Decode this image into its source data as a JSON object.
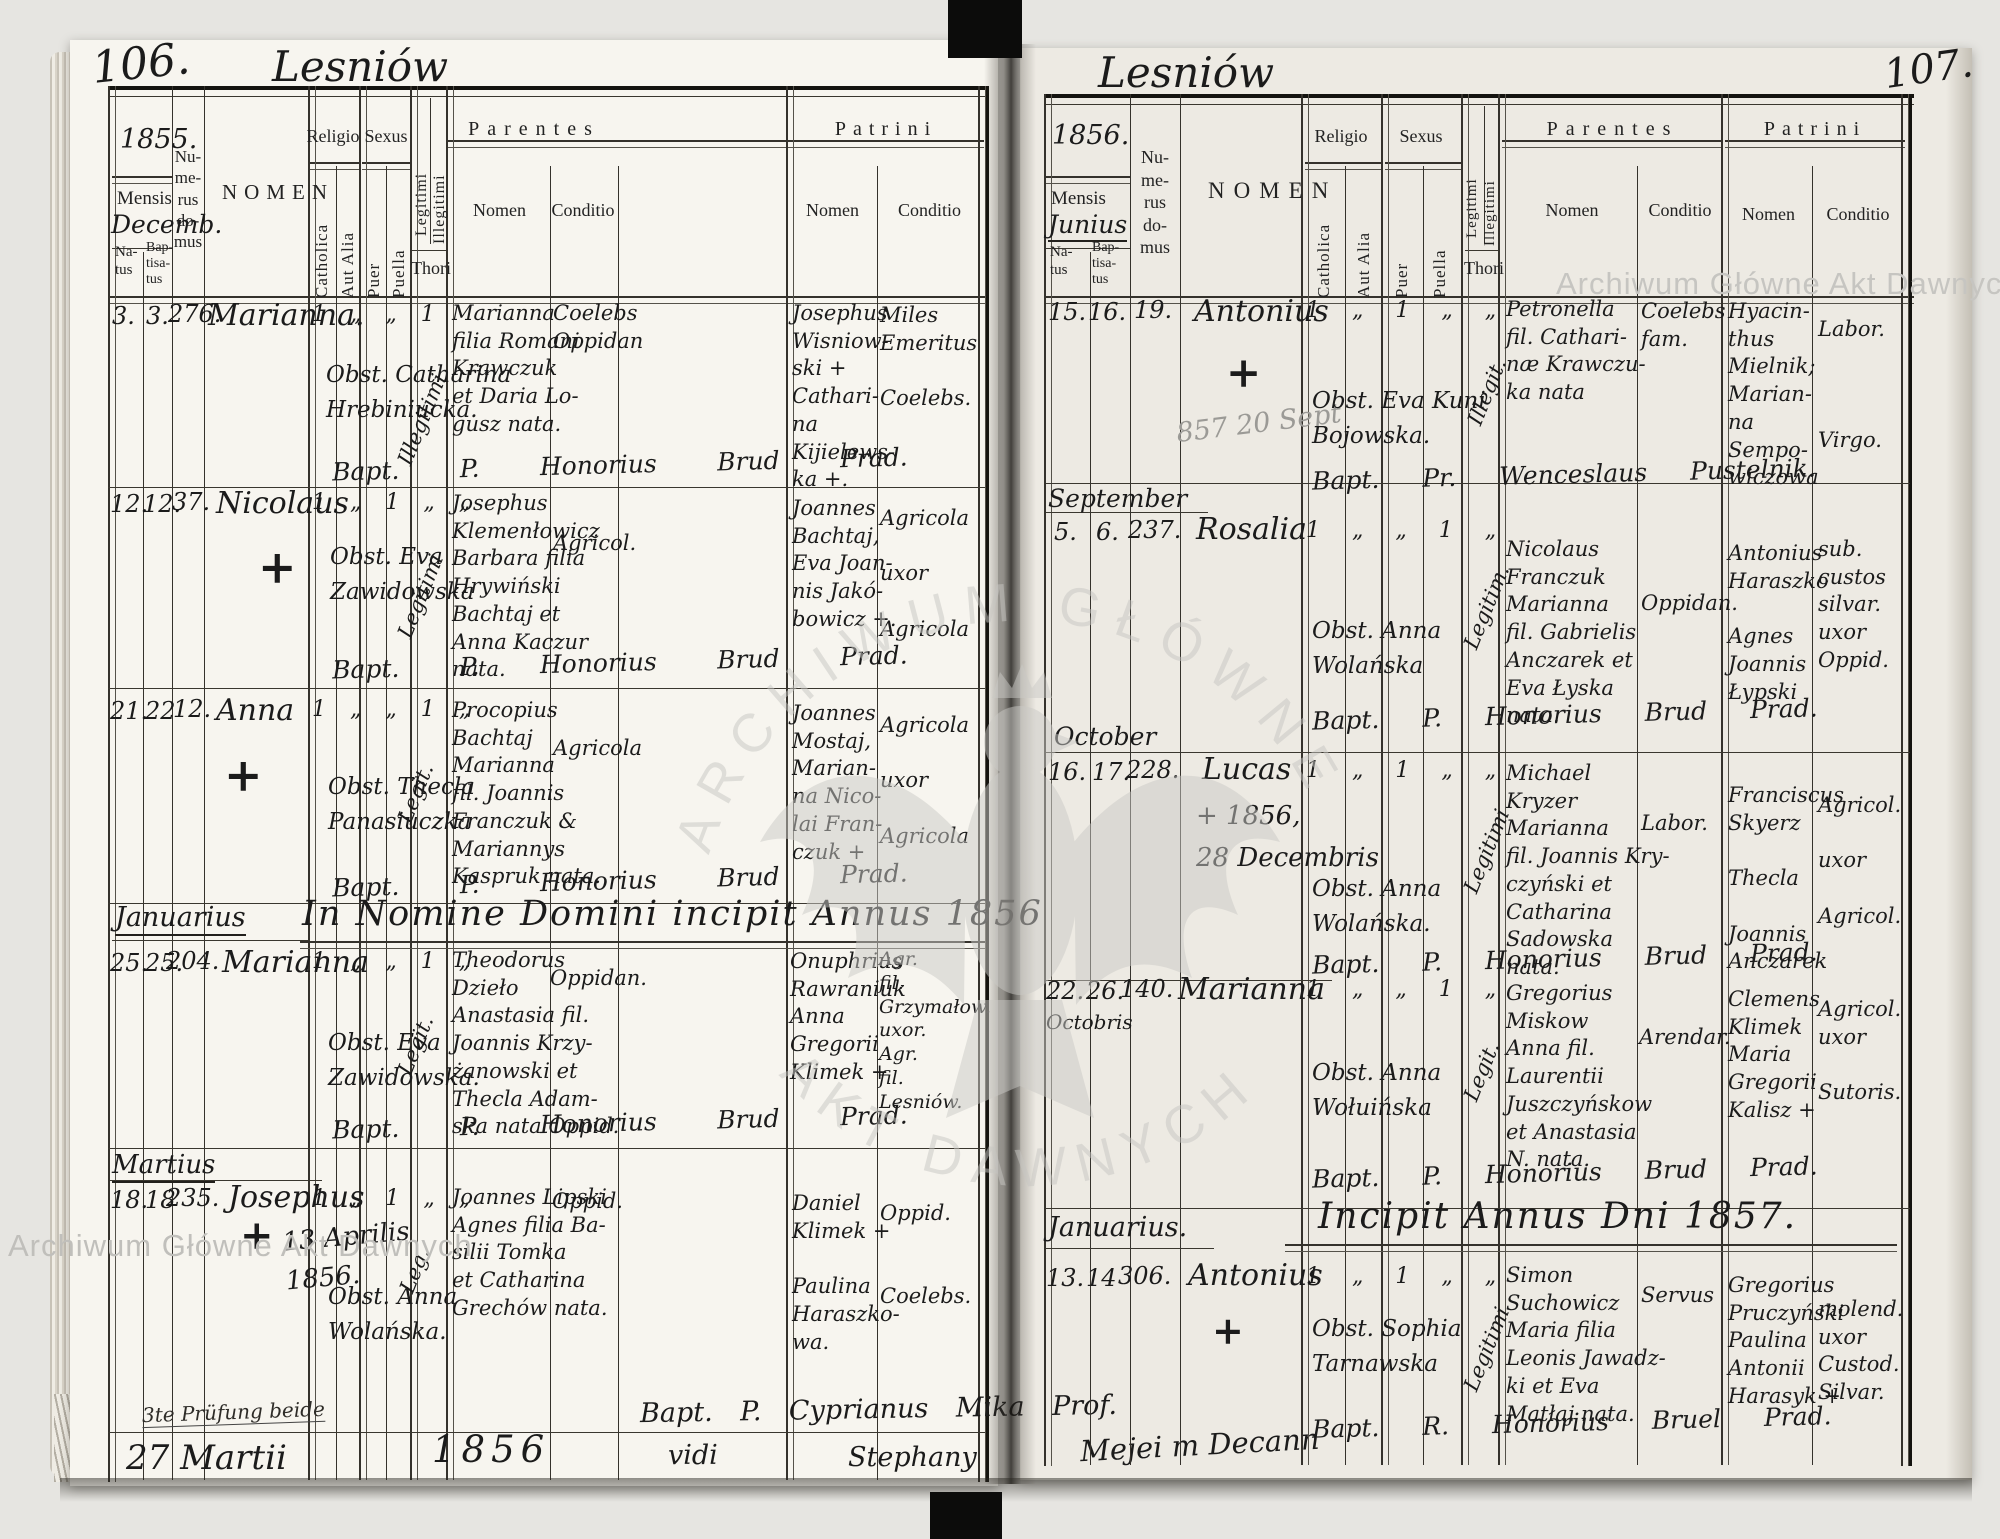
{
  "watermarks": {
    "corner_top_right": "Archiwum Główne Akt Dawnych",
    "corner_bottom_left": "Archiwum Główne Akt Dawnych",
    "stamp_top": "ARCHIWUM GŁÓWNE",
    "stamp_bottom": "AKT DAWNYCH"
  },
  "labels": {
    "mensis": "Mensis",
    "natus": "Na-\ntus",
    "baptisatus": "Bap-\ntisa-\ntus",
    "numerus": "Nu-\nme-\nrus\ndo-\nmus",
    "nomen": "NOMEN",
    "religio": "Religio",
    "catholica": "Catholica",
    "aut_alia": "Aut Alia",
    "sexus": "Sexus",
    "puer": "Puer",
    "puella": "Puella",
    "legitimi": "Legitimi",
    "illegitimi": "Illegitimi",
    "thori": "Thori",
    "parentes": "Parentes",
    "patrini": "Patrini",
    "nomen_sub": "Nomen",
    "conditio": "Conditio"
  },
  "left_page": {
    "page_no": "106.",
    "title": "Lesniów",
    "year": "1855.",
    "month": "Decemb.",
    "sections": {
      "jan": "Januarius",
      "heading_1856": "In Nomine Domini incipit Annus 1856",
      "mar": "Martius"
    },
    "entries": [
      {
        "natus": "3.",
        "baptisatus": "3.",
        "domus": "276.",
        "nomen": "Marianna.",
        "ticks": "1 „ „ 1",
        "legit": "Illegitimi",
        "obst": "Obst. Catharina\nHrebiniucka.",
        "parentes": "Marianna\nfilia Romani\nKrawczuk\net Daria Lo-\ngusz nata.",
        "parentes_cond": "Coelebs\nOppidan",
        "patrini": "Josephus\nWisniow-\nski +\nCathari-\nna\nKijielews-\nka +.",
        "patrini_cond": "Miles\nEmeritus\n\nCoelebs.",
        "bapt": "Bapt. P. Honorius Brud Prad."
      },
      {
        "natus": "12.",
        "baptisatus": "12.",
        "domus": "37.",
        "nomen": "Nicolaus",
        "cross": "+",
        "ticks": "1 „ 1 „ „",
        "legit": "Legitimi",
        "obst": "Obst. Eva\nZawidowska",
        "parentes": "Josephus\nKlemenłowicz\nBarbara filia\nHrywiński\nBachtaj et\nAnna Kaczur\nnata.",
        "parentes_cond": "Agricol.",
        "patrini": "Joannes\nBachtaj,\nEva Joan-\nnis Jakó-\nbowicz +.",
        "patrini_cond": "Agricola\n\nuxor\n\nAgricola",
        "bapt": "Bapt. P. Honorius Brud Prad."
      },
      {
        "natus": "21.",
        "baptisatus": "22",
        "domus": "12.",
        "nomen": "Anna",
        "cross": "+",
        "ticks": "1 „ „ 1 „",
        "legit": "Legit.",
        "obst": "Obst. Thecla\nPanasiuczka",
        "parentes": "Procopius\nBachtaj\nMarianna\nfil. Joannis\nFranczuk &\nMariannys\nKaspruk nata.",
        "parentes_cond": "Agricola",
        "patrini": "Joannes\nMostaj,\nMarian-\nna Nico-\nlai Fran-\nczuk +",
        "patrini_cond": "Agricola\n\nuxor\n\nAgricola",
        "bapt": "Bapt. P. Honorius Brud Prad."
      },
      {
        "natus": "25.",
        "baptisatus": "25.",
        "domus": "204.",
        "nomen": "Marianna",
        "ticks": "1 „ „ 1 „",
        "legit": "Legit.",
        "obst": "Obst. Eva\nZawidowska.",
        "parentes": "Theodorus\nDzieło\nAnastasia fil.\nJoannis Krzy-\nżanowski et\nThecla Adam-\nska nata Oppid.",
        "parentes_cond": "Oppidan.",
        "patrini": "Onuphrius\nRawraniuk\nAnna\nGregorii\nKlimek +",
        "patrini_cond": "Agr.\nfil.\nGrzymałow.\nuxor.\nAgr.\nfil.\nLesniów.",
        "bapt": "Bapt. P. Honorius Brud Prad."
      },
      {
        "natus": "18.",
        "baptisatus": "18",
        "domus": "235.",
        "nomen": "Josephus",
        "cross": "+",
        "note": "13 Aprilis\n1856.",
        "ticks": "1 „ 1 „ „",
        "legit": "Leg.",
        "obst": "Obst. Anna\nWolańska.",
        "parentes": "Joannes Lipski\nAgnes filia Ba-\nsilii Tomka\net Catharina\nGrechów nata.",
        "parentes_cond": "Oppid.",
        "patrini": "Daniel\nKlimek +\n\nPaulina\nHaraszko-\nwa.",
        "patrini_cond": "Oppid.\n\n\nCoelebs."
      }
    ],
    "bottom_notes": {
      "scrawl": "3te Prüfung beide",
      "date": "27 Martii",
      "year": "1856",
      "vidi": "vidi",
      "bapt": "Bapt. P. Cyprianus Mika Prof.",
      "sig1": "Stephany",
      "sig2": "Mejei m Decann"
    }
  },
  "right_page": {
    "page_no": "107.",
    "title": "Lesniów",
    "year": "1856.",
    "month": "Junius",
    "sections": {
      "sep": "September",
      "oct": "October",
      "jan": "Januarius.",
      "heading_1857": "Incipit Annus Dni 1857."
    },
    "entries": [
      {
        "natus": "15.",
        "baptisatus": "16.",
        "domus": "19.",
        "nomen": "Antonius",
        "cross": "+",
        "pencil": "857 20 Sept",
        "ticks": "1 „ 1 „ „",
        "legit": "Illegit.",
        "obst": "Obst. Eva Kuni\nBojowska.",
        "parentes": "Petronella\nfil. Cathari-\nnæ Krawczu-\nka nata",
        "parentes_cond": "Coelebs\nfam.",
        "patrini": "Hyacin-\nthus\nMielnik;\nMarian-\nna\nSempo-\nwiczowa",
        "patrini_cond": "Labor.\n\n\n\nVirgo.",
        "bapt": "Bapt. Pr. Wenceslaus Pustelnik."
      },
      {
        "natus": "5.",
        "baptisatus": "6.",
        "domus": "237.",
        "nomen": "Rosalia",
        "ticks": "1 „ „ 1 „",
        "legit": "Legitim.",
        "obst": "Obst. Anna\nWolańska",
        "parentes": "Nicolaus\nFranczuk\nMarianna\nfil. Gabrielis\nAnczarek et\nEva Łyska\nnata.",
        "parentes_cond": "Oppidan.",
        "patrini": "Antonius\nHaraszko\n\nAgnes\nJoannis\nŁypski",
        "patrini_cond": "sub.\ncustos\nsilvar.\nuxor\nOppid.",
        "bapt": "Bapt. P. Honorius Brud Prad."
      },
      {
        "natus": "16.",
        "baptisatus": "17.",
        "domus": "228.",
        "nomen": "Lucas",
        "note": "+ 1856,\n28 Decembris",
        "ticks": "1 „ 1 „ „",
        "legit": "Legitimi",
        "obst": "Obst. Anna\nWolańska.",
        "parentes": "Michael\nKryzer\nMarianna\nfil. Joannis Kry-\nczyński et\nCatharina\nSadowska\nnata.",
        "parentes_cond": "Labor.",
        "patrini": "Franciscus\nSkyerz\n\nThecla\n\nJoannis\nAnczarek",
        "patrini_cond": "Agricol.\n\nuxor\n\nAgricol.",
        "bapt": "Bapt. P. Honorius Brud Prad."
      },
      {
        "natus": "22.",
        "baptisatus": "26.",
        "domus": "140.",
        "nomen": "Marianna",
        "date_note": "Octobris",
        "ticks": "1 „ „ 1 „",
        "legit": "Legit.",
        "obst": "Obst. Anna\nWołuińska",
        "parentes": "Gregorius\nMiskow\nAnna fil.\nLaurentii\nJuszczyńskow\net Anastasia\nN. nata.",
        "parentes_cond": "Arendar.",
        "patrini": "Clemens\nKlimek\nMaria\nGregorii\nKalisz +",
        "patrini_cond": "Agricol.\nuxor\n\nSutoris.",
        "bapt": "Bapt. P. Honorius Brud Prad."
      },
      {
        "natus": "13.",
        "baptisatus": "14",
        "domus": "306.",
        "nomen": "Antonius",
        "cross": "+",
        "ticks": "1 „ 1 „ „",
        "legit": "Legitimi",
        "obst": "Obst. Sophia\nTarnawska",
        "parentes": "Simon\nSuchowicz\nMaria filia\nLeonis Jawadz-\nki et Eva\nMatłaj nata.",
        "parentes_cond": "Servus",
        "patrini": "Gregorius\nPruczyński\nPaulina\nAntonii\nHarasyk +",
        "patrini_cond": "molend.\nuxor\nCustod.\nSilvar.",
        "bapt": "Bapt. R. Honorius Bruel Prad."
      }
    ]
  }
}
